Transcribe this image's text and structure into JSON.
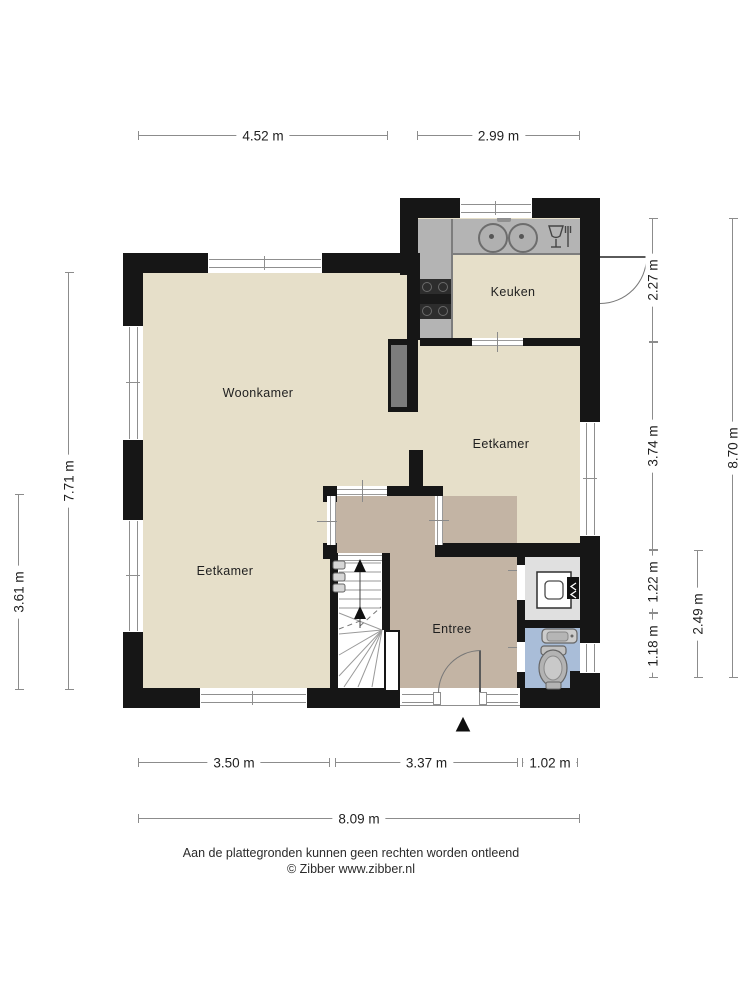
{
  "rooms": {
    "keuken": {
      "label": "Keuken"
    },
    "woonkamer": {
      "label": "Woonkamer"
    },
    "eetkamer_left": {
      "label": "Eetkamer"
    },
    "eetkamer_right": {
      "label": "Eetkamer"
    },
    "entree": {
      "label": "Entree"
    }
  },
  "dimensions": {
    "top": [
      {
        "label": "4.52 m"
      },
      {
        "label": "2.99 m"
      }
    ],
    "bottom_inner": [
      {
        "label": "3.50 m"
      },
      {
        "label": "3.37 m"
      },
      {
        "label": "1.02 m"
      }
    ],
    "bottom_total": {
      "label": "8.09 m"
    },
    "left_inner": {
      "label": "3.61 m"
    },
    "left_total": {
      "label": "7.71 m"
    },
    "right_inner": [
      {
        "label": "2.27 m"
      },
      {
        "label": "3.74 m"
      },
      {
        "label": "1.22 m"
      },
      {
        "label": "1.18 m"
      }
    ],
    "right_mid": {
      "label": "2.49 m"
    },
    "right_total": {
      "label": "8.70 m"
    }
  },
  "footer": {
    "disclaimer": "Aan de plattegronden kunnen geen rechten worden ontleend",
    "copyright": "© Zibber www.zibber.nl"
  },
  "icons": {
    "north_arrow": "▲"
  },
  "colors": {
    "wall": "#161616",
    "floor": "#e6dfc9",
    "entree": "#c3b4a4",
    "toilet": "#a9bdd8",
    "meterkast": "#e0e0e0",
    "counter": "#b4b4b4",
    "counter_edge": "#7d7d7d",
    "chimney": "#7c7c7c",
    "stove": "#2d2d2d",
    "dim": "#8c8c8c",
    "text": "#1f1f1f",
    "frame": "#8f8f8f"
  }
}
